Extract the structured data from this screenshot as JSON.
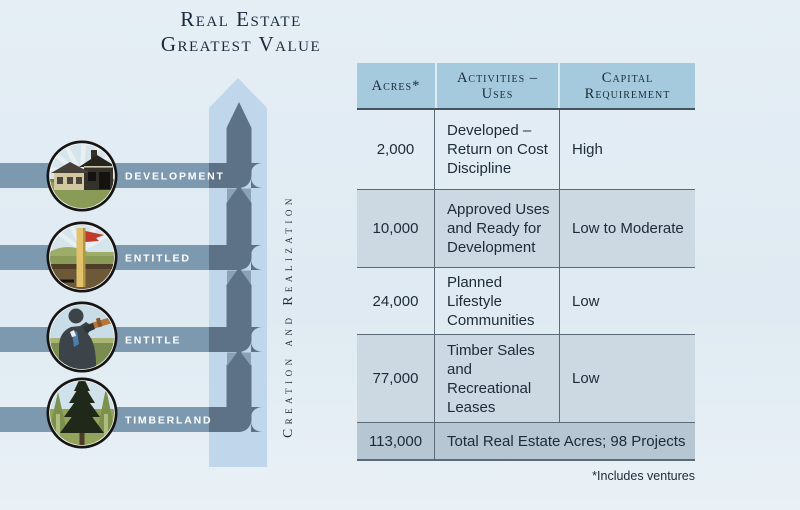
{
  "title": {
    "line1": "Real Estate",
    "line2": "Greatest Value"
  },
  "diagram": {
    "axis_label": "Creation and Realization",
    "levels": [
      {
        "label": "DEVELOPMENT",
        "icon": "house-development-icon"
      },
      {
        "label": "ENTITLED",
        "icon": "survey-stake-flag-icon"
      },
      {
        "label": "ENTITLE",
        "icon": "surveyor-telescope-icon"
      },
      {
        "label": "TIMBERLAND",
        "icon": "pine-tree-icon"
      }
    ]
  },
  "table": {
    "headers": [
      "Acres*",
      "Activities – Uses",
      "Capital Requirement"
    ],
    "rows": [
      {
        "acres": "2,000",
        "activities": "Developed – Return on Cost Discipline",
        "capital": "High"
      },
      {
        "acres": "10,000",
        "activities": "Approved Uses and Ready for Development",
        "capital": "Low to Moderate"
      },
      {
        "acres": "24,000",
        "activities": "Planned Lifestyle Communities",
        "capital": "Low"
      },
      {
        "acres": "77,000",
        "activities": "Timber Sales and Recreational Leases",
        "capital": "Low"
      }
    ],
    "total": {
      "acres": "113,000",
      "label": "Total Real Estate Acres; 98 Projects"
    },
    "footnote": "*Includes ventures"
  },
  "colors": {
    "background": "#e2ecf4",
    "band": "#7d99b0",
    "arrow_light": "#bfd6eb",
    "path_dark": "#5d7286",
    "junction_mid": "#8aa2b6",
    "header_bg": "#a5cade",
    "row_alt": "#ccd8e2",
    "total_row": "#b7c6d3",
    "text_dark": "#1d2b38",
    "label_white": "#ffffff"
  }
}
